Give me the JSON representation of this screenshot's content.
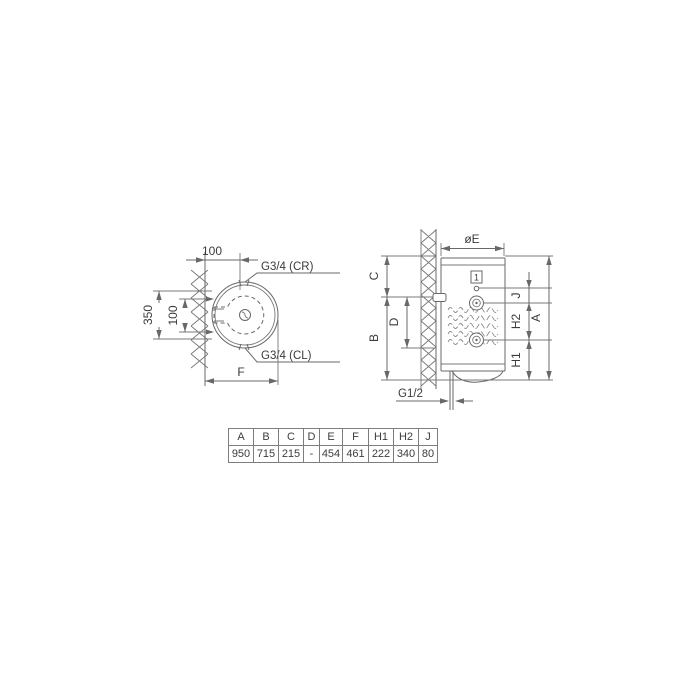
{
  "left_view": {
    "dim_offset_top": "100",
    "dim_350": "350",
    "dim_100": "100",
    "label_top": "G3/4 (CR)",
    "label_bottom": "G3/4 (CL)",
    "dim_f": "F"
  },
  "right_view": {
    "dim_diameter": "øE",
    "dim_c": "C",
    "dim_b": "B",
    "dim_d": "D",
    "dim_j": "J",
    "dim_h2": "H2",
    "dim_h1": "H1",
    "dim_a": "A",
    "callout_1": "1",
    "label_bottom_pipe": "G1/2"
  },
  "table": {
    "headers": [
      "A",
      "B",
      "C",
      "D",
      "E",
      "F",
      "H1",
      "H2",
      "J"
    ],
    "values": [
      "950",
      "715",
      "215",
      "-",
      "454",
      "461",
      "222",
      "340",
      "80"
    ]
  },
  "colors": {
    "line": "#686868",
    "text": "#3a3a3a",
    "table_border": "#7d7d7d"
  }
}
